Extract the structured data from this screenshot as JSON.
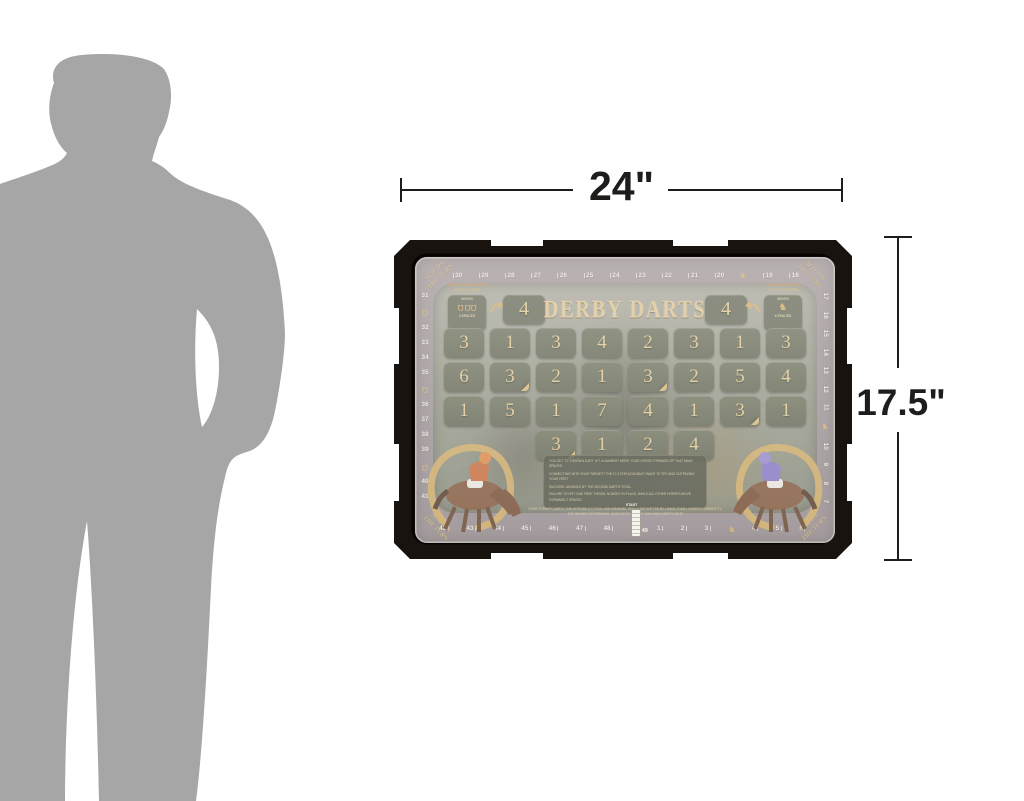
{
  "size_chart": {
    "width_label": "24\"",
    "height_label": "17.5\""
  },
  "board": {
    "title": "DERBY DARTS",
    "score_left": "4",
    "score_right": "4",
    "corner_text_line1": "SLIP ON",
    "corner_text_line2": "THE TURN",
    "powerup_left": {
      "note1": "YOUR POWER THROW",
      "note2": "USE ANY TIME",
      "box_top": "MOVES",
      "box_bottom": "3 SPACES"
    },
    "powerup_right": {
      "note1": "THE GOLDEN HORSE",
      "note2": "GET TO THE WIN",
      "box_top": "MOVES",
      "box_bottom": "6 SPACES"
    },
    "rules_panel": {
      "lines": [
        "YOU GET TO THROW A DART. HIT A NUMBER? MOVE YOUR HORSE FORWARD OF THAT MANY SPACES.",
        "CONNECTING WITH YOUR TARGET? THE 17-2 FOR A DOUBLE? WANT TO TRY AND OUTPACING YOUR FIRST",
        "SUCCESS. ADVANCE BY THE SECOND DART'S TOTAL.",
        "FAILURE TO HIT? ONE FREE THROW. NOBODY IN PLACE, WHILE ALL OTHER HORSES MOVE FORWARD 2 SPACES."
      ]
    },
    "footnote_lines": [
      "YOUR CORNER CARDS: THE OPTIONS (17) TICK. HIGH REWARD. ROLL A DIE DOTTED BY USING YOUR LONGEST NUMBER T.V.",
      "THE WINNER DETERMINED. ALSO MOST CHOICE HOW MANY MEETS NICE!"
    ],
    "start": {
      "label": "START",
      "number": "49"
    }
  },
  "track": {
    "top": [
      "30",
      "29",
      "28",
      "27",
      "26",
      "25",
      "24",
      "23",
      "22",
      "21",
      "20",
      "icon:horse",
      "19",
      "18"
    ],
    "left": [
      "31",
      "icon:shoe",
      "32",
      "33",
      "34",
      "35",
      "icon:shoe",
      "36",
      "37",
      "38",
      "39",
      "icon:shoe",
      "40",
      "41"
    ],
    "right": [
      "17",
      "16",
      "15",
      "14",
      "13",
      "12",
      "11",
      "icon:horse",
      "10",
      "9",
      "8",
      "7"
    ],
    "bottom": [
      "42",
      "43",
      "44",
      "45",
      "46",
      "47",
      "48",
      "start",
      "1",
      "2",
      "3",
      "icon:horse",
      "4",
      "5",
      "6"
    ]
  },
  "grid": {
    "rows": [
      [
        "3",
        "1",
        "3",
        "4",
        "2",
        "3",
        "1",
        "3"
      ],
      [
        "6",
        "3",
        "2",
        "1",
        "3",
        "2",
        "5",
        "4"
      ],
      [
        "1",
        "5",
        "1",
        "7",
        "4",
        "1",
        "3",
        "1"
      ],
      [
        "3",
        "1",
        "2",
        "4"
      ]
    ],
    "folds": [
      [
        1,
        1
      ],
      [
        1,
        4
      ],
      [
        2,
        6
      ],
      [
        3,
        0
      ]
    ]
  },
  "colors": {
    "gold": "#c9a45f",
    "cell_olive": "#5d614d",
    "frame_black": "#191310",
    "jockey_left_silks": "#c4632f",
    "jockey_right_silks": "#7f6cc0",
    "silhouette_gray": "#a6a6a6"
  }
}
